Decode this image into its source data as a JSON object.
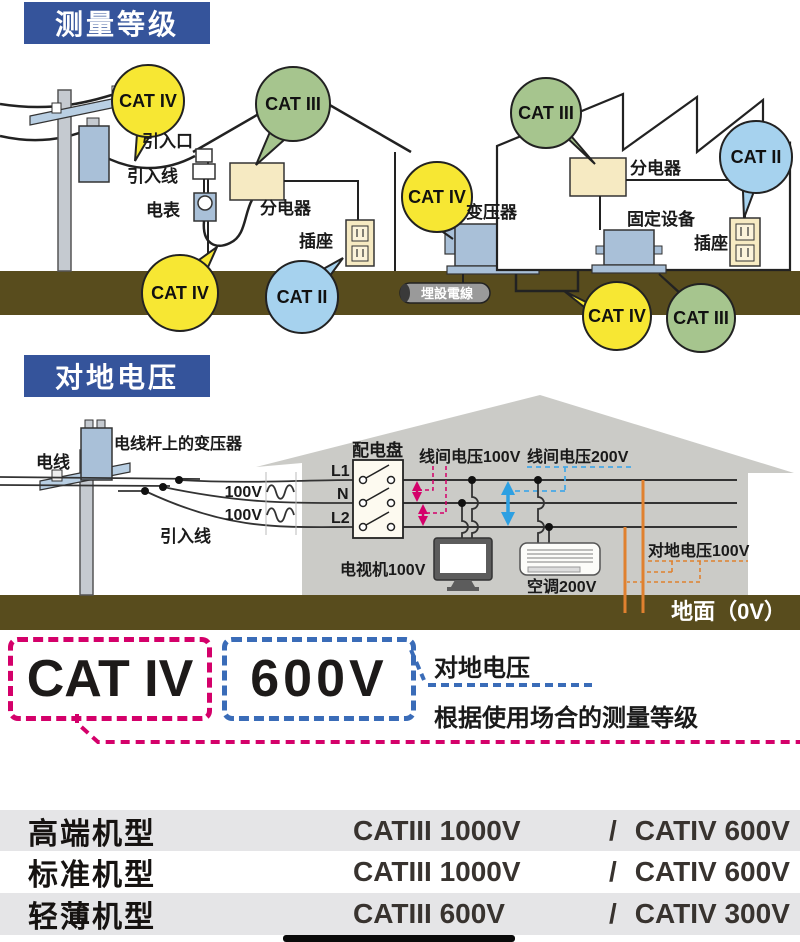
{
  "section1": {
    "header": "测量等级",
    "labels": {
      "entry_point": "引入口",
      "service_wire": "引入线",
      "meter": "电表",
      "house_distributor": "分电器",
      "house_outlet": "插座",
      "transformer": "变压器",
      "buried_cable": "埋設電線",
      "factory_distributor": "分电器",
      "fixed_equipment": "固定设备",
      "factory_outlet": "插座"
    },
    "balloons": [
      {
        "label": "CAT IV",
        "color": "#f7e733"
      },
      {
        "label": "CAT III",
        "color": "#a6c58e"
      },
      {
        "label": "CAT IV",
        "color": "#f7e733"
      },
      {
        "label": "CAT II",
        "color": "#a6d2ee"
      },
      {
        "label": "CAT IV",
        "color": "#f7e733"
      },
      {
        "label": "CAT III",
        "color": "#a6c58e"
      },
      {
        "label": "CAT II",
        "color": "#a6d2ee"
      },
      {
        "label": "CAT IV",
        "color": "#f7e733"
      },
      {
        "label": "CAT III",
        "color": "#a6c58e"
      }
    ]
  },
  "section2": {
    "header": "对地电压",
    "labels": {
      "wire": "电线",
      "pole_transformer": "电线杆上的变压器",
      "service_wire": "引入线",
      "voltage_top": "100V",
      "voltage_bottom": "100V",
      "l1": "L1",
      "n": "N",
      "l2": "L2",
      "panel": "配电盘",
      "line_voltage_100": "线间电压100V",
      "line_voltage_200": "线间电压200V",
      "tv": "电视机100V",
      "aircon": "空调200V",
      "ground_voltage": "对地电压100V",
      "ground": "地面（0V）"
    }
  },
  "section3": {
    "category": "CAT IV",
    "voltage": "600V",
    "voltage_note": "对地电压",
    "category_note": "根据使用场合的测量等级"
  },
  "table": {
    "rows": [
      {
        "model": "高端机型",
        "cat3": "CATIII 1000V",
        "slash": "/",
        "cat4": "CATIV 600V"
      },
      {
        "model": "标准机型",
        "cat3": "CATIII 1000V",
        "slash": "/",
        "cat4": "CATIV 600V"
      },
      {
        "model": "轻薄机型",
        "cat3": "CATIII 600V",
        "slash": "/",
        "cat4": "CATIV 300V"
      }
    ]
  },
  "colors": {
    "header_bg": "#35549b",
    "ground": "#584c1d",
    "balloon_yellow": "#f7e733",
    "balloon_green": "#a6c58e",
    "balloon_blue": "#a6d2ee",
    "magenta": "#d4006a",
    "dashed_blue": "#3a6cb8",
    "arrow_blue": "#2da0e2",
    "orange": "#e0812f"
  }
}
